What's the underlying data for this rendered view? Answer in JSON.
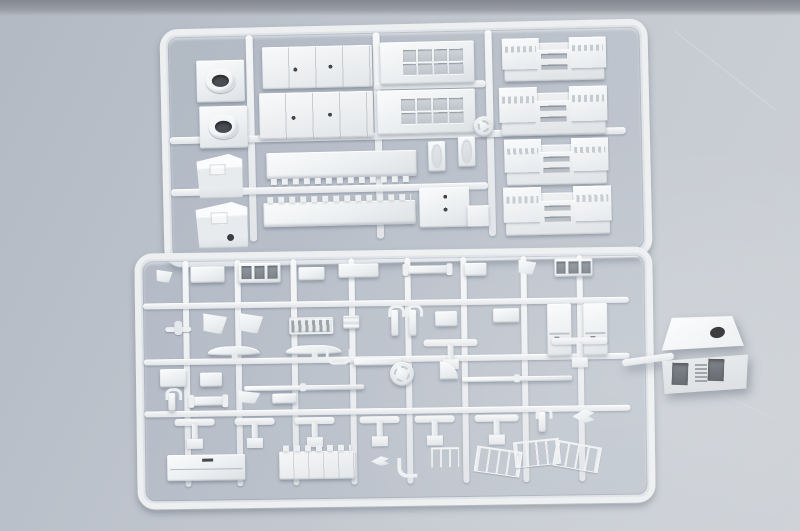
{
  "scene": {
    "description": "Photograph of two injection-molded light-gray polystyrene sprues of ship model kit parts lying on a blue-gray surface; a cube-shaped deckhouse part is attached by a short runner stub to the right edge of the lower sprue.",
    "surface": {
      "base_color": "#bcc2cb",
      "light_color": "#cdd1d6",
      "top_edge_strip_color": "#84878f"
    },
    "plastic": {
      "base_color": "#eceff1",
      "highlight_color": "#fafbfc",
      "shadow_color": "#dde1e4",
      "recess_color": "#bec4ca",
      "hole_color": "#2c2f33"
    }
  },
  "sprues": [
    {
      "id": "sprue-top",
      "description": "Upper sprue with large superstructure blocks: two funnel caps with round openings, two wedge-shaped deckhouse blocks, paneled slabs, two long notched deck strips, two window-grid deckhouse blocks, two small hatch frames, an L-shaped block, a round mold stamp and four bridge-deck pieces with window strips.",
      "frame": {
        "left": 162,
        "top": 24,
        "width": 472,
        "height": 222,
        "rotate_deg": -1.3
      },
      "runners": [
        {
          "x": 78,
          "y": 0,
          "w": 7,
          "h": 206
        },
        {
          "x": 205,
          "y": 0,
          "w": 7,
          "h": 206
        },
        {
          "x": 317,
          "y": 0,
          "w": 7,
          "h": 206
        },
        {
          "x": 0,
          "y": 100,
          "w": 456,
          "h": 7
        },
        {
          "x": 0,
          "y": 152,
          "w": 317,
          "h": 7
        },
        {
          "x": 205,
          "y": 50,
          "w": 112,
          "h": 7
        }
      ],
      "parts": [
        {
          "name": "funnel-cap-1",
          "type": "funnel-cap",
          "x": 28,
          "y": 24,
          "w": 48,
          "h": 42
        },
        {
          "name": "funnel-cap-2",
          "type": "funnel-cap",
          "x": 30,
          "y": 70,
          "w": 48,
          "h": 42
        },
        {
          "name": "deckhouse-wedge-1",
          "type": "wedge",
          "x": 26,
          "y": 118,
          "w": 46,
          "h": 44
        },
        {
          "name": "deckhouse-wedge-2",
          "type": "wedge",
          "variant": "dot",
          "x": 24,
          "y": 166,
          "w": 52,
          "h": 46
        },
        {
          "name": "panel-slab-1",
          "type": "panel-slab",
          "x": 94,
          "y": 12,
          "w": 110,
          "h": 42
        },
        {
          "name": "panel-slab-2",
          "type": "panel-slab",
          "x": 90,
          "y": 58,
          "w": 114,
          "h": 46
        },
        {
          "name": "notched-deck-1",
          "type": "notched-deck",
          "variant": "teeth-bottom",
          "x": 96,
          "y": 118,
          "w": 150,
          "h": 26
        },
        {
          "name": "notched-deck-2",
          "type": "notched-deck",
          "variant": "teeth-top",
          "x": 92,
          "y": 168,
          "w": 152,
          "h": 24
        },
        {
          "name": "window-block-1",
          "type": "window-grid",
          "x": 212,
          "y": 10,
          "w": 94,
          "h": 42
        },
        {
          "name": "window-block-2",
          "type": "window-grid",
          "x": 208,
          "y": 58,
          "w": 98,
          "h": 44
        },
        {
          "name": "hatch-frame-1",
          "type": "hatch-frame",
          "x": 258,
          "y": 110,
          "w": 17,
          "h": 30
        },
        {
          "name": "hatch-frame-2",
          "type": "hatch-frame",
          "x": 288,
          "y": 106,
          "w": 17,
          "h": 30
        },
        {
          "name": "l-shaped-block",
          "type": "l-block",
          "x": 248,
          "y": 156,
          "w": 50,
          "h": 40
        },
        {
          "name": "mold-stamp-top",
          "type": "disc",
          "x": 304,
          "y": 86,
          "w": 20,
          "h": 20
        },
        {
          "name": "bridge-deck-1",
          "type": "bridge-deck",
          "x": 336,
          "y": 14,
          "w": 100,
          "h": 38
        },
        {
          "name": "bridge-deck-2",
          "type": "bridge-deck",
          "x": 332,
          "y": 64,
          "w": 104,
          "h": 42
        },
        {
          "name": "bridge-deck-3",
          "type": "bridge-deck",
          "x": 336,
          "y": 116,
          "w": 100,
          "h": 40
        },
        {
          "name": "bridge-deck-4",
          "type": "bridge-deck",
          "x": 334,
          "y": 164,
          "w": 104,
          "h": 42
        }
      ]
    },
    {
      "id": "sprue-bottom",
      "description": "Lower sprue densely packed with small fittings: platforms, window frames, vent grille, fairing wedges, davits, cabin sides, curved yardarms, T-shaped masts, thin yards, a round mold stamp, two long deck pieces (one crenellated), railings and other small detail parts.",
      "frame": {
        "left": 136,
        "top": 250,
        "width": 502,
        "height": 240,
        "rotate_deg": -0.8
      },
      "runners": [
        {
          "x": 40,
          "y": 0,
          "w": 6,
          "h": 226
        },
        {
          "x": 92,
          "y": 0,
          "w": 6,
          "h": 226
        },
        {
          "x": 148,
          "y": 0,
          "w": 6,
          "h": 226
        },
        {
          "x": 206,
          "y": 0,
          "w": 6,
          "h": 226
        },
        {
          "x": 262,
          "y": 0,
          "w": 6,
          "h": 226
        },
        {
          "x": 318,
          "y": 0,
          "w": 6,
          "h": 226
        },
        {
          "x": 378,
          "y": 0,
          "w": 6,
          "h": 226
        },
        {
          "x": 434,
          "y": 0,
          "w": 6,
          "h": 226
        },
        {
          "x": 0,
          "y": 42,
          "w": 486,
          "h": 6
        },
        {
          "x": 0,
          "y": 98,
          "w": 486,
          "h": 6
        },
        {
          "x": 0,
          "y": 150,
          "w": 486,
          "h": 6
        }
      ],
      "parts": [
        {
          "name": "angled-bracket",
          "type": "fin-wedge",
          "x": 14,
          "y": 8,
          "w": 16,
          "h": 14
        },
        {
          "name": "platform-small-1",
          "type": "box",
          "x": 48,
          "y": 6,
          "w": 34,
          "h": 16
        },
        {
          "name": "window-frame-a",
          "type": "window-frame-3",
          "x": 96,
          "y": 3,
          "w": 42,
          "h": 20
        },
        {
          "name": "box-small-1",
          "type": "box",
          "x": 156,
          "y": 8,
          "w": 26,
          "h": 13
        },
        {
          "name": "box-wide-1",
          "type": "box",
          "x": 196,
          "y": 5,
          "w": 40,
          "h": 14
        },
        {
          "name": "bar-with-caps",
          "type": "bar-caps",
          "x": 262,
          "y": 8,
          "w": 46,
          "h": 8
        },
        {
          "name": "box-small-2",
          "type": "box",
          "x": 322,
          "y": 6,
          "w": 22,
          "h": 13
        },
        {
          "name": "angled-chock",
          "type": "fin-wedge",
          "x": 376,
          "y": 3,
          "w": 18,
          "h": 16
        },
        {
          "name": "window-frame-b",
          "type": "window-frame-3",
          "x": 412,
          "y": 3,
          "w": 38,
          "h": 18
        },
        {
          "name": "float-plane",
          "type": "plane",
          "x": 22,
          "y": 60,
          "w": 26,
          "h": 14
        },
        {
          "name": "fairing-fin-1",
          "type": "fin-wedge",
          "x": 60,
          "y": 52,
          "w": 24,
          "h": 22
        },
        {
          "name": "fairing-fin-2",
          "type": "fin-wedge",
          "x": 96,
          "y": 52,
          "w": 24,
          "h": 22
        },
        {
          "name": "vent-grille",
          "type": "vent-grill",
          "x": 146,
          "y": 58,
          "w": 40,
          "h": 13
        },
        {
          "name": "grate-small",
          "type": "ladder",
          "x": 200,
          "y": 57,
          "w": 16,
          "h": 13
        },
        {
          "name": "davit-1",
          "type": "davit",
          "x": 248,
          "y": 52,
          "w": 7,
          "h": 26
        },
        {
          "name": "davit-2",
          "type": "davit",
          "x": 266,
          "y": 52,
          "w": 7,
          "h": 26
        },
        {
          "name": "box-small-3",
          "type": "box",
          "x": 292,
          "y": 54,
          "w": 22,
          "h": 15
        },
        {
          "name": "platform-small-2",
          "type": "box",
          "x": 350,
          "y": 52,
          "w": 26,
          "h": 14
        },
        {
          "name": "cabin-side-1",
          "type": "tall-slab",
          "x": 404,
          "y": 48,
          "w": 24,
          "h": 52
        },
        {
          "name": "cabin-side-2",
          "type": "tall-slab",
          "x": 440,
          "y": 48,
          "w": 24,
          "h": 52
        },
        {
          "name": "yardarm-curved-1",
          "type": "curved-yard",
          "x": 64,
          "y": 86,
          "w": 52,
          "h": 9
        },
        {
          "name": "yardarm-curved-2",
          "type": "curved-yard",
          "x": 142,
          "y": 86,
          "w": 56,
          "h": 9
        },
        {
          "name": "mast-tee-1",
          "type": "t-mast",
          "x": 280,
          "y": 82,
          "w": 54,
          "h": 30
        },
        {
          "name": "mast-tee-2",
          "type": "t-mast",
          "x": 408,
          "y": 82,
          "w": 56,
          "h": 30
        },
        {
          "name": "u-bracket",
          "type": "u-bracket",
          "x": 182,
          "y": 90,
          "w": 20,
          "h": 13
        },
        {
          "name": "support-bar",
          "type": "bar",
          "x": 210,
          "y": 100,
          "w": 48,
          "h": 7
        },
        {
          "name": "mold-stamp-bottom",
          "type": "disc",
          "x": 246,
          "y": 104,
          "w": 24,
          "h": 24
        },
        {
          "name": "pad-box-1",
          "type": "box",
          "x": 16,
          "y": 108,
          "w": 26,
          "h": 18
        },
        {
          "name": "pad-box-2",
          "type": "box",
          "x": 56,
          "y": 112,
          "w": 22,
          "h": 14
        },
        {
          "name": "quarter-platform",
          "type": "quarter-disc",
          "x": 296,
          "y": 104,
          "w": 18,
          "h": 18
        },
        {
          "name": "yard-thin-1",
          "type": "thin-yard",
          "x": 100,
          "y": 126,
          "w": 120,
          "h": 5
        },
        {
          "name": "yard-thin-2",
          "type": "thin-yard",
          "x": 318,
          "y": 120,
          "w": 110,
          "h": 5
        },
        {
          "name": "fitting-small-1",
          "type": "davit",
          "x": 24,
          "y": 132,
          "w": 7,
          "h": 18
        },
        {
          "name": "deck-fitting",
          "type": "bar-caps",
          "x": 46,
          "y": 136,
          "w": 36,
          "h": 9
        },
        {
          "name": "wedge-small",
          "type": "fin-wedge",
          "x": 94,
          "y": 130,
          "w": 22,
          "h": 14
        },
        {
          "name": "bollard-pair",
          "type": "box",
          "x": 128,
          "y": 134,
          "w": 24,
          "h": 10
        },
        {
          "name": "mast-tee-3",
          "type": "t-mast",
          "x": 30,
          "y": 158,
          "w": 40,
          "h": 30
        },
        {
          "name": "mast-tee-4",
          "type": "t-mast",
          "x": 90,
          "y": 158,
          "w": 40,
          "h": 30
        },
        {
          "name": "mast-tee-5",
          "type": "t-mast",
          "x": 150,
          "y": 158,
          "w": 40,
          "h": 30
        },
        {
          "name": "mast-tee-6",
          "type": "t-mast",
          "x": 215,
          "y": 158,
          "w": 40,
          "h": 30
        },
        {
          "name": "mast-tee-7",
          "type": "t-mast",
          "x": 270,
          "y": 158,
          "w": 40,
          "h": 30
        },
        {
          "name": "mast-tee-8",
          "type": "t-mast",
          "x": 330,
          "y": 158,
          "w": 44,
          "h": 30
        },
        {
          "name": "fitting-small-2",
          "type": "davit",
          "x": 394,
          "y": 156,
          "w": 7,
          "h": 20
        },
        {
          "name": "dart-wing",
          "type": "dart",
          "x": 428,
          "y": 154,
          "w": 22,
          "h": 14
        },
        {
          "name": "deck-plain",
          "type": "long-deck",
          "x": 22,
          "y": 194,
          "w": 78,
          "h": 26
        },
        {
          "name": "deck-crenellated",
          "type": "cren-deck",
          "x": 134,
          "y": 192,
          "w": 76,
          "h": 28
        },
        {
          "name": "boat-small",
          "type": "dart",
          "x": 226,
          "y": 198,
          "w": 18,
          "h": 10
        },
        {
          "name": "pipe-bend",
          "type": "pipe-bend",
          "x": 252,
          "y": 200,
          "w": 16,
          "h": 16
        },
        {
          "name": "rail-small",
          "type": "railing",
          "x": 286,
          "y": 190,
          "w": 28,
          "h": 18
        },
        {
          "name": "railing-span",
          "type": "railing-assembly",
          "x": 330,
          "y": 182,
          "w": 126,
          "h": 40
        }
      ]
    }
  ],
  "loose_part": {
    "id": "deckhouse-cube",
    "description": "Cube-shaped deckhouse block with a round black opening on the top face and two dark rectangular hatches plus a small vent strip on the front face, joined to the lower sprue by a short runner stub."
  }
}
